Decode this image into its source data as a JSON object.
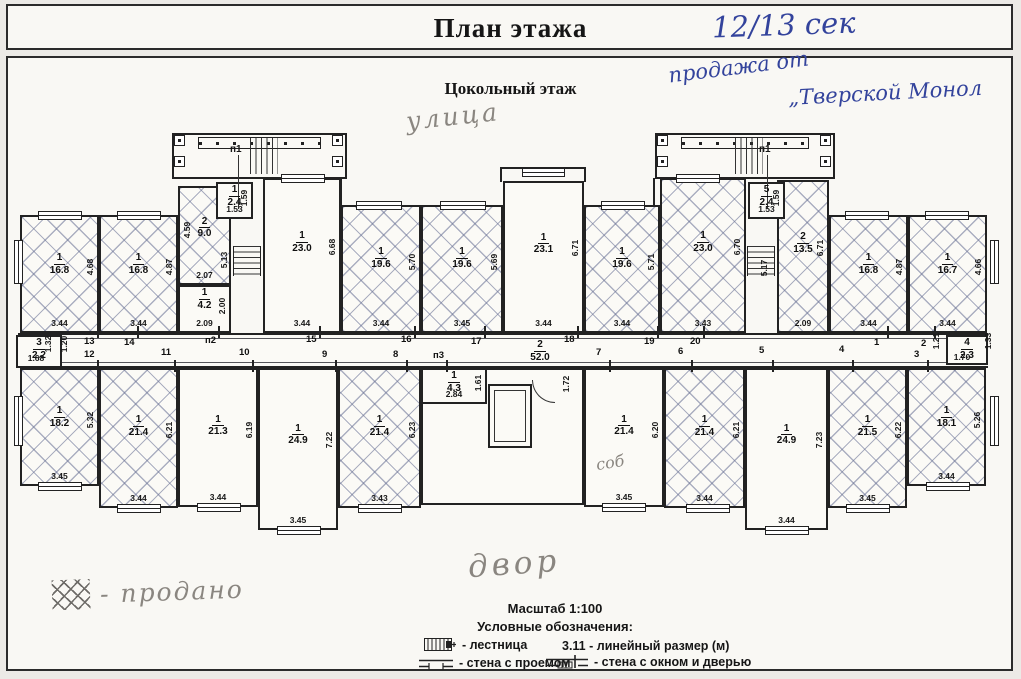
{
  "title": "План этажа",
  "subtitle": "Цокольный этаж",
  "annotations": {
    "section": "12/13 сек",
    "sale_line1": "продажа от",
    "sale_line2": "„Тверской Монол",
    "street": "улица",
    "yard": "двор",
    "sold_note": "- продано",
    "sob": "соб"
  },
  "legend": {
    "scale": "Масштаб 1:100",
    "heading": "Условные обозначения:",
    "items": [
      {
        "icon": "stairs-icon",
        "label": "- лестница"
      },
      {
        "icon": "dimension-sample",
        "label": "3.11 - линейный размер (м)"
      },
      {
        "icon": "wall-opening-icon",
        "label": "- стена с проемом"
      },
      {
        "icon": "wall-window-door-icon",
        "label": "- стена с окном и дверью"
      }
    ]
  },
  "plan": {
    "corridor": {
      "x": 18,
      "y": 333,
      "w": 970,
      "h": 35
    },
    "rooms": [
      {
        "id": "1",
        "area": "16.8",
        "x": 20,
        "y": 215,
        "w": 79,
        "h": 118,
        "hatch": true,
        "dw": "3.44",
        "dh": "4.68"
      },
      {
        "id": "1",
        "area": "16.8",
        "x": 99,
        "y": 215,
        "w": 79,
        "h": 118,
        "hatch": true,
        "dw": "3.44",
        "dh": "4.87"
      },
      {
        "id": "2",
        "area": "9.0",
        "x": 178,
        "y": 186,
        "w": 53,
        "h": 99,
        "hatch": true,
        "dw": "2.07",
        "dh": "4.59",
        "ds": "left"
      },
      {
        "id": "1",
        "area": "4.2",
        "x": 178,
        "y": 285,
        "w": 53,
        "h": 48,
        "dw": "2.09",
        "dh": "2.00"
      },
      {
        "id": "1",
        "area": "2.4",
        "x": 216,
        "y": 182,
        "w": 37,
        "h": 37,
        "dw": "1.53",
        "dh": "1.59",
        "top": true
      },
      {
        "id": "1",
        "area": "23.0",
        "x": 263,
        "y": 178,
        "w": 78,
        "h": 155,
        "dw": "3.44",
        "dh": "6.68"
      },
      {
        "id": "1",
        "area": "19.6",
        "x": 341,
        "y": 205,
        "w": 80,
        "h": 128,
        "hatch": true,
        "dw": "3.44",
        "dh": "5.70"
      },
      {
        "id": "1",
        "area": "19.6",
        "x": 421,
        "y": 205,
        "w": 82,
        "h": 128,
        "hatch": true,
        "dw": "3.45",
        "dh": "5.69"
      },
      {
        "id": "1",
        "area": "23.1",
        "x": 503,
        "y": 181,
        "w": 81,
        "h": 152,
        "dw": "3.44",
        "dh": "6.71"
      },
      {
        "id": "1",
        "area": "19.6",
        "x": 584,
        "y": 205,
        "w": 76,
        "h": 128,
        "hatch": true,
        "dw": "3.44",
        "dh": "5.71"
      },
      {
        "id": "1",
        "area": "23.0",
        "x": 660,
        "y": 178,
        "w": 86,
        "h": 155,
        "hatch": true,
        "dw": "3.43",
        "dh": "6.70"
      },
      {
        "id": "5",
        "area": "2.4",
        "x": 748,
        "y": 182,
        "w": 37,
        "h": 37,
        "dw": "1.53",
        "dh": "1.59",
        "top": true
      },
      {
        "id": "2",
        "area": "13.5",
        "x": 777,
        "y": 180,
        "w": 52,
        "h": 153,
        "hatch": true,
        "dw": "2.09",
        "dh": "6.71"
      },
      {
        "id": "1",
        "area": "16.8",
        "x": 829,
        "y": 215,
        "w": 79,
        "h": 118,
        "hatch": true,
        "dw": "3.44",
        "dh": "4.87"
      },
      {
        "id": "1",
        "area": "16.7",
        "x": 908,
        "y": 215,
        "w": 79,
        "h": 118,
        "hatch": true,
        "dw": "3.44",
        "dh": "4.66"
      },
      {
        "id": "3",
        "area": "2.2",
        "x": 16,
        "y": 335,
        "w": 46,
        "h": 33
      },
      {
        "id": "1",
        "area": "18.2",
        "x": 20,
        "y": 368,
        "w": 79,
        "h": 118,
        "hatch": true,
        "dw": "3.45",
        "dh": "5.32"
      },
      {
        "id": "1",
        "area": "21.4",
        "x": 99,
        "y": 368,
        "w": 79,
        "h": 140,
        "hatch": true,
        "dw": "3.44",
        "dh": "6.21"
      },
      {
        "id": "1",
        "area": "21.3",
        "x": 178,
        "y": 368,
        "w": 80,
        "h": 139,
        "dw": "3.44",
        "dh": "6.19"
      },
      {
        "id": "1",
        "area": "24.9",
        "x": 258,
        "y": 368,
        "w": 80,
        "h": 162,
        "dw": "3.45",
        "dh": "7.22"
      },
      {
        "id": "1",
        "area": "21.4",
        "x": 338,
        "y": 368,
        "w": 83,
        "h": 140,
        "hatch": true,
        "dw": "3.43",
        "dh": "6.23"
      },
      {
        "id": "2",
        "area": "52.0",
        "x": 421,
        "y": 368,
        "w": 163,
        "h": 137,
        "lx": 540,
        "ly": 339
      },
      {
        "id": "1",
        "area": "4.3",
        "x": 421,
        "y": 368,
        "w": 66,
        "h": 36,
        "dw": "2.84",
        "dh": "1.61",
        "top": true
      },
      {
        "id": "1",
        "area": "21.4",
        "x": 584,
        "y": 368,
        "w": 80,
        "h": 139,
        "dw": "3.45",
        "dh": "6.20"
      },
      {
        "id": "1",
        "area": "21.4",
        "x": 664,
        "y": 368,
        "w": 81,
        "h": 140,
        "hatch": true,
        "dw": "3.44",
        "dh": "6.21"
      },
      {
        "id": "1",
        "area": "24.9",
        "x": 745,
        "y": 368,
        "w": 83,
        "h": 162,
        "dw": "3.44",
        "dh": "7.23"
      },
      {
        "id": "1",
        "area": "21.5",
        "x": 828,
        "y": 368,
        "w": 79,
        "h": 140,
        "hatch": true,
        "dw": "3.45",
        "dh": "6.22"
      },
      {
        "id": "1",
        "area": "18.1",
        "x": 907,
        "y": 368,
        "w": 79,
        "h": 118,
        "hatch": true,
        "dw": "3.44",
        "dh": "5.26"
      },
      {
        "id": "4",
        "area": "2.3",
        "x": 946,
        "y": 335,
        "w": 42,
        "h": 30
      }
    ],
    "points": [
      {
        "t": "13",
        "x": 84,
        "y": 336,
        "s": "t"
      },
      {
        "t": "14",
        "x": 124,
        "y": 337,
        "s": "t"
      },
      {
        "t": "п2",
        "x": 205,
        "y": 335,
        "s": "t"
      },
      {
        "t": "15",
        "x": 306,
        "y": 334,
        "s": "t"
      },
      {
        "t": "16",
        "x": 401,
        "y": 334,
        "s": "t"
      },
      {
        "t": "17",
        "x": 471,
        "y": 336,
        "s": "t"
      },
      {
        "t": "18",
        "x": 564,
        "y": 334,
        "s": "t"
      },
      {
        "t": "19",
        "x": 644,
        "y": 336,
        "s": "t"
      },
      {
        "t": "20",
        "x": 690,
        "y": 336,
        "s": "t"
      },
      {
        "t": "1",
        "x": 874,
        "y": 337,
        "s": "t"
      },
      {
        "t": "2",
        "x": 921,
        "y": 338,
        "s": "t"
      },
      {
        "t": "12",
        "x": 84,
        "y": 349,
        "s": "b"
      },
      {
        "t": "11",
        "x": 161,
        "y": 347,
        "s": "b"
      },
      {
        "t": "10",
        "x": 239,
        "y": 347,
        "s": "b"
      },
      {
        "t": "9",
        "x": 322,
        "y": 349,
        "s": "b"
      },
      {
        "t": "8",
        "x": 393,
        "y": 349,
        "s": "b"
      },
      {
        "t": "п3",
        "x": 433,
        "y": 350,
        "s": "b"
      },
      {
        "t": "7",
        "x": 596,
        "y": 347,
        "s": "b"
      },
      {
        "t": "6",
        "x": 678,
        "y": 346,
        "s": "b"
      },
      {
        "t": "5",
        "x": 759,
        "y": 345,
        "s": "b"
      },
      {
        "t": "4",
        "x": 839,
        "y": 344,
        "s": "b"
      },
      {
        "t": "3",
        "x": 914,
        "y": 349,
        "s": "b"
      }
    ],
    "extra_dims": [
      {
        "t": "1.68",
        "x": 36,
        "y": 358,
        "r": 0
      },
      {
        "t": "1.32",
        "x": 48,
        "y": 344,
        "r": 1
      },
      {
        "t": "1.20",
        "x": 64,
        "y": 344,
        "r": 1
      },
      {
        "t": "1.70",
        "x": 962,
        "y": 357,
        "r": 0
      },
      {
        "t": "1.21",
        "x": 936,
        "y": 341,
        "r": 1
      },
      {
        "t": "1.33",
        "x": 988,
        "y": 341,
        "r": 1
      },
      {
        "t": "5.13",
        "x": 224,
        "y": 260,
        "r": 1
      },
      {
        "t": "5.17",
        "x": 764,
        "y": 268,
        "r": 1
      },
      {
        "t": "1.72",
        "x": 566,
        "y": 384,
        "r": 1
      }
    ],
    "windows": [
      {
        "x": 38,
        "y": 211,
        "w": 44
      },
      {
        "x": 117,
        "y": 211,
        "w": 44
      },
      {
        "x": 281,
        "y": 174,
        "w": 44
      },
      {
        "x": 356,
        "y": 201,
        "w": 46
      },
      {
        "x": 440,
        "y": 201,
        "w": 46
      },
      {
        "x": 522,
        "y": 168,
        "w": 43
      },
      {
        "x": 601,
        "y": 201,
        "w": 44
      },
      {
        "x": 676,
        "y": 174,
        "w": 44
      },
      {
        "x": 845,
        "y": 211,
        "w": 44
      },
      {
        "x": 925,
        "y": 211,
        "w": 44
      },
      {
        "x": 38,
        "y": 482,
        "w": 44
      },
      {
        "x": 117,
        "y": 504,
        "w": 44
      },
      {
        "x": 197,
        "y": 503,
        "w": 44
      },
      {
        "x": 277,
        "y": 526,
        "w": 44
      },
      {
        "x": 358,
        "y": 504,
        "w": 44
      },
      {
        "x": 602,
        "y": 503,
        "w": 44
      },
      {
        "x": 686,
        "y": 504,
        "w": 44
      },
      {
        "x": 765,
        "y": 526,
        "w": 44
      },
      {
        "x": 846,
        "y": 504,
        "w": 44
      },
      {
        "x": 926,
        "y": 482,
        "w": 44
      },
      {
        "x": 14,
        "y": 240,
        "h": 44,
        "v": true
      },
      {
        "x": 14,
        "y": 396,
        "h": 50,
        "v": true
      },
      {
        "x": 990,
        "y": 240,
        "h": 44,
        "v": true
      },
      {
        "x": 990,
        "y": 396,
        "h": 50,
        "v": true
      }
    ],
    "towers": [
      {
        "x": 172,
        "y": 133,
        "w": 175,
        "h": 46,
        "label": "п1",
        "lxo": 58,
        "sx": 78
      },
      {
        "x": 655,
        "y": 133,
        "w": 180,
        "h": 46,
        "label": "п1",
        "lxo": 104,
        "sx": 80
      }
    ],
    "stairs_mid": [
      {
        "x": 233,
        "y": 246,
        "w": 28,
        "h": 30
      },
      {
        "x": 747,
        "y": 246,
        "w": 28,
        "h": 30
      }
    ],
    "wallsegs": [
      {
        "x": 340,
        "y": 178,
        "w": 2,
        "h": 28
      },
      {
        "x": 653,
        "y": 178,
        "w": 2,
        "h": 28
      },
      {
        "x": 500,
        "y": 167,
        "w": 86,
        "h": 2
      },
      {
        "x": 500,
        "y": 167,
        "w": 2,
        "h": 15
      },
      {
        "x": 584,
        "y": 167,
        "w": 2,
        "h": 15
      }
    ],
    "lift": {
      "x": 488,
      "y": 384,
      "w": 44,
      "h": 64
    },
    "door_arc": {
      "x": 532,
      "y": 380,
      "s": 22
    }
  }
}
